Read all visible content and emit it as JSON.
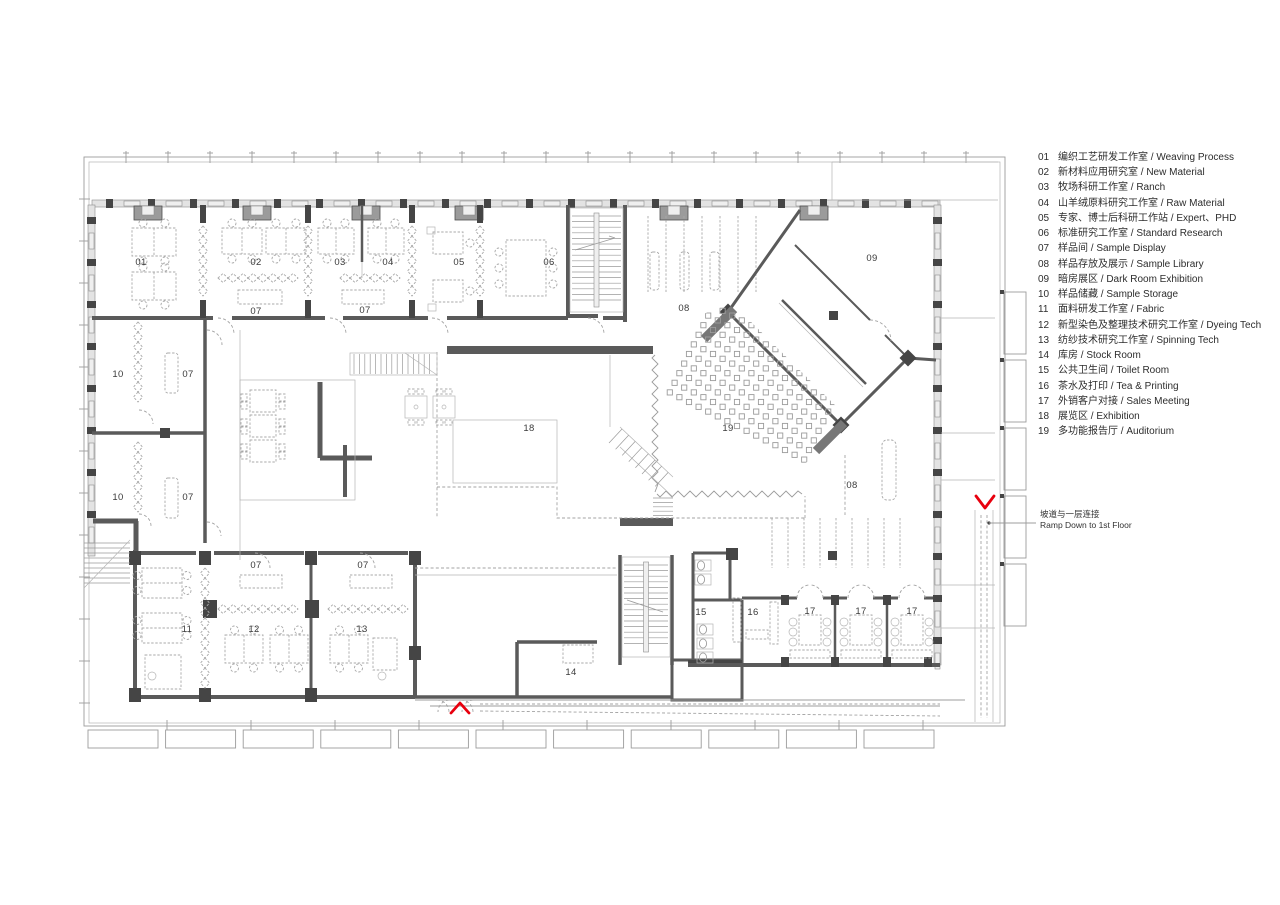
{
  "legend": {
    "items": [
      {
        "no": "01",
        "label": "编织工艺研发工作室 / Weaving Process"
      },
      {
        "no": "02",
        "label": "新材料应用研究室 / New Material"
      },
      {
        "no": "03",
        "label": "牧场科研工作室 / Ranch"
      },
      {
        "no": "04",
        "label": "山羊绒原料研究工作室 / Raw Material"
      },
      {
        "no": "05",
        "label": "专家、博士后科研工作站 / Expert、PHD"
      },
      {
        "no": "06",
        "label": "标准研究工作室 / Standard Research"
      },
      {
        "no": "07",
        "label": "样品间 / Sample Display"
      },
      {
        "no": "08",
        "label": "样品存放及展示 / Sample Library"
      },
      {
        "no": "09",
        "label": "暗房展区 / Dark Room Exhibition"
      },
      {
        "no": "10",
        "label": "样品储藏 / Sample Storage"
      },
      {
        "no": "11",
        "label": "面料研发工作室 / Fabric"
      },
      {
        "no": "12",
        "label": "新型染色及整理技术研究工作室 / Dyeing Tech"
      },
      {
        "no": "13",
        "label": "纺纱技术研究工作室 / Spinning Tech"
      },
      {
        "no": "14",
        "label": "库房 / Stock Room"
      },
      {
        "no": "15",
        "label": "公共卫生间 / Toilet Room"
      },
      {
        "no": "16",
        "label": "茶水及打印 / Tea & Printing"
      },
      {
        "no": "17",
        "label": "外销客户对接 / Sales Meeting"
      },
      {
        "no": "18",
        "label": "展览区 / Exhibition"
      },
      {
        "no": "19",
        "label": "多功能报告厅 / Auditorium"
      }
    ]
  },
  "plan_labels": [
    {
      "t": "01",
      "x": 141,
      "y": 265
    },
    {
      "t": "02",
      "x": 256,
      "y": 265
    },
    {
      "t": "03",
      "x": 340,
      "y": 265
    },
    {
      "t": "04",
      "x": 388,
      "y": 265
    },
    {
      "t": "05",
      "x": 459,
      "y": 265
    },
    {
      "t": "06",
      "x": 549,
      "y": 265
    },
    {
      "t": "07",
      "x": 256,
      "y": 314
    },
    {
      "t": "07",
      "x": 365,
      "y": 313
    },
    {
      "t": "08",
      "x": 684,
      "y": 311
    },
    {
      "t": "09",
      "x": 872,
      "y": 261
    },
    {
      "t": "10",
      "x": 118,
      "y": 377
    },
    {
      "t": "07",
      "x": 188,
      "y": 377
    },
    {
      "t": "10",
      "x": 118,
      "y": 500
    },
    {
      "t": "07",
      "x": 188,
      "y": 500
    },
    {
      "t": "18",
      "x": 529,
      "y": 431
    },
    {
      "t": "19",
      "x": 728,
      "y": 431
    },
    {
      "t": "08",
      "x": 852,
      "y": 488
    },
    {
      "t": "07",
      "x": 256,
      "y": 568
    },
    {
      "t": "07",
      "x": 363,
      "y": 568
    },
    {
      "t": "11",
      "x": 187,
      "y": 632
    },
    {
      "t": "12",
      "x": 254,
      "y": 632
    },
    {
      "t": "13",
      "x": 362,
      "y": 632
    },
    {
      "t": "14",
      "x": 571,
      "y": 675
    },
    {
      "t": "15",
      "x": 701,
      "y": 615
    },
    {
      "t": "16",
      "x": 753,
      "y": 615
    },
    {
      "t": "17",
      "x": 810,
      "y": 614
    },
    {
      "t": "17",
      "x": 861,
      "y": 614
    },
    {
      "t": "17",
      "x": 912,
      "y": 614
    }
  ],
  "callout": {
    "line1": "坡道与一层连接",
    "line2": "Ramp Down to 1st Floor"
  },
  "markers": [
    {
      "name": "entrance-chevron-up",
      "dir": "up",
      "x": 460,
      "y": 713
    },
    {
      "name": "ramp-chevron-down",
      "dir": "down",
      "x": 985,
      "y": 496
    }
  ],
  "colors": {
    "red": "#e8000e",
    "wall": "#5a5a5a",
    "thin": "#9c9c9c"
  }
}
